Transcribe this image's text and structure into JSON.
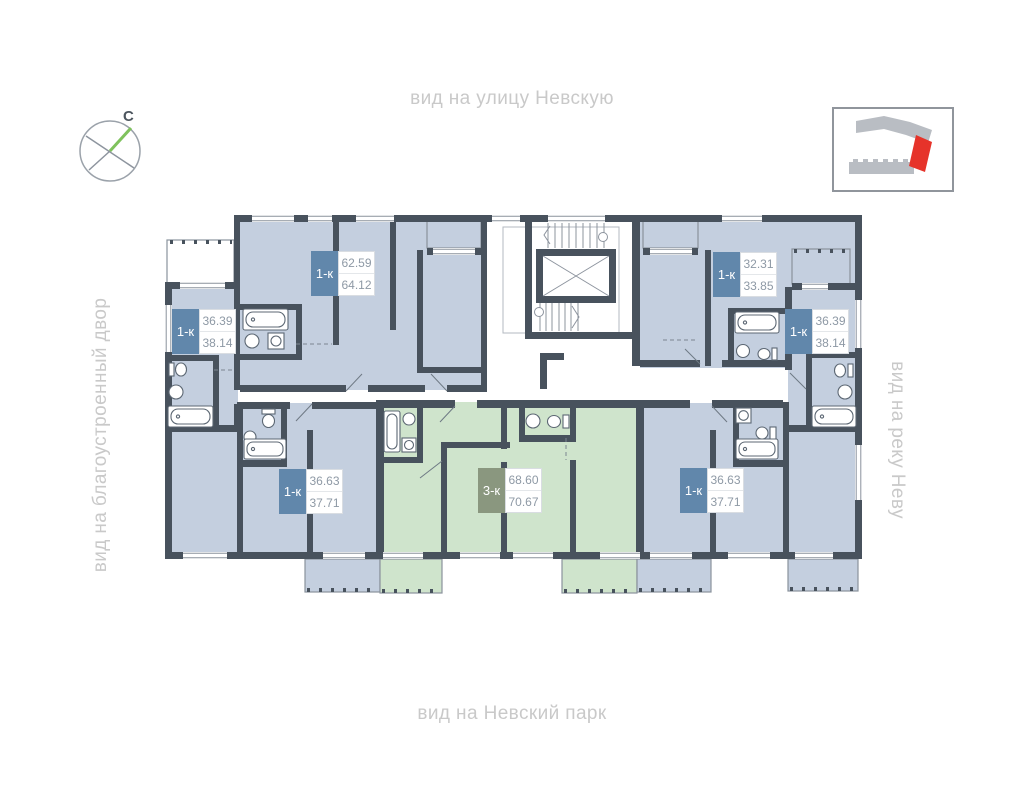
{
  "labels": {
    "top": "вид на улицу Невскую",
    "left": "вид на благоустроенный двор",
    "right": "вид на реку Неву",
    "bottom": "вид на Невский парк"
  },
  "compass": {
    "north_label": "С"
  },
  "colors": {
    "wall": "#48525d",
    "apartment_blue": "#c4cfdf",
    "apartment_green": "#cfe4cc",
    "badge_blue": "#6187ab",
    "badge_green": "#8a977f",
    "area_text": "#8e99a5",
    "peripheral_text": "#c9c9c9",
    "minimap_building": "#b9bdc3",
    "minimap_highlight": "#e6332a",
    "compass_needle": "#7fc25d"
  },
  "apartments": [
    {
      "id": "left",
      "type": "1-к",
      "area_living": "36.39",
      "area_total": "38.14",
      "color": "blue"
    },
    {
      "id": "top-left",
      "type": "1-к",
      "area_living": "62.59",
      "area_total": "64.12",
      "color": "blue"
    },
    {
      "id": "top-right",
      "type": "1-к",
      "area_living": "32.31",
      "area_total": "33.85",
      "color": "blue"
    },
    {
      "id": "right",
      "type": "1-к",
      "area_living": "36.39",
      "area_total": "38.14",
      "color": "blue"
    },
    {
      "id": "bottom-left",
      "type": "1-к",
      "area_living": "36.63",
      "area_total": "37.71",
      "color": "blue"
    },
    {
      "id": "bottom-middle",
      "type": "3-к",
      "area_living": "68.60",
      "area_total": "70.67",
      "color": "green"
    },
    {
      "id": "bottom-right",
      "type": "1-к",
      "area_living": "36.63",
      "area_total": "37.71",
      "color": "blue"
    }
  ]
}
